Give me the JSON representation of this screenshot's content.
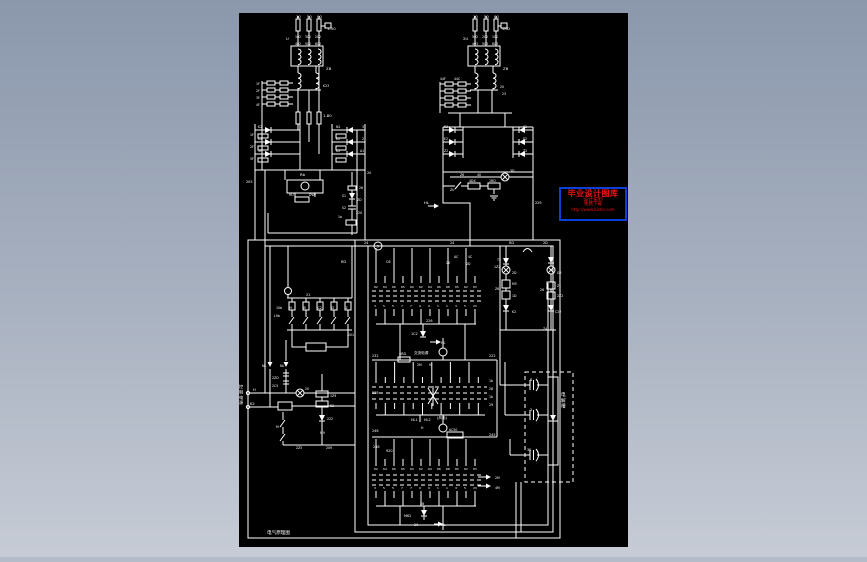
{
  "scene": {
    "bg_top": "#8b98ac",
    "bg_bottom": "#c7ccd6",
    "bg_strip": "#b5bcc9",
    "canvas_bg": "#000000",
    "ink": "#ffffff"
  },
  "watermark": {
    "border_color": "#0a3fd8",
    "bg": "#000000",
    "text_color": "#ef1212",
    "lines": [
      "毕业设计图库",
      "设计资料",
      "免费下载",
      "http://www.bishe.com"
    ]
  },
  "drawing": {
    "footer_note": "电气原理图",
    "ladder_labels": [
      "H",
      "B",
      "C2",
      "D",
      "Z"
    ],
    "strips": [
      {
        "top": [
          "62",
          "64",
          "66",
          "65",
          "60",
          "62",
          "64",
          "66",
          "68",
          "65",
          "62",
          "63"
        ],
        "bottom": [
          "3",
          "5",
          "5",
          "7",
          "7",
          "9",
          "9",
          "1",
          "1",
          "3",
          "5",
          "23"
        ]
      },
      {
        "top": [
          "",
          "",
          "",
          "",
          "",
          "",
          "",
          "",
          "",
          "",
          "",
          ""
        ],
        "bottom": [
          "",
          "",
          "",
          "",
          "",
          "",
          "",
          "",
          "",
          "",
          "",
          ""
        ]
      },
      {
        "top": [
          "62",
          "64",
          "66",
          "65",
          "60",
          "62",
          "64",
          "66",
          "68",
          "65",
          "62",
          "63"
        ],
        "bottom": [
          "3",
          "5",
          "5",
          "7",
          "7",
          "9",
          "9",
          "1",
          "1",
          "3",
          "5",
          "23"
        ]
      }
    ],
    "labels": [
      {
        "t": "10",
        "x": 296,
        "y": 18
      },
      {
        "t": "50",
        "x": 307,
        "y": 18
      },
      {
        "t": "00",
        "x": 317,
        "y": 18
      },
      {
        "t": "1-50",
        "x": 327,
        "y": 30
      },
      {
        "t": "U",
        "x": 286,
        "y": 40
      },
      {
        "t": "102",
        "x": 295,
        "y": 38,
        "s": 3.2
      },
      {
        "t": "302",
        "x": 305,
        "y": 38,
        "s": 3.2
      },
      {
        "t": "202",
        "x": 315,
        "y": 38,
        "s": 3.2
      },
      {
        "t": "402",
        "x": 295,
        "y": 45,
        "s": 3.2
      },
      {
        "t": "502",
        "x": 305,
        "y": 45,
        "s": 3.2
      },
      {
        "t": "602",
        "x": 315,
        "y": 45,
        "s": 3.2
      },
      {
        "t": "ZB",
        "x": 326,
        "y": 70
      },
      {
        "t": "1F",
        "x": 256,
        "y": 85,
        "s": 3.2
      },
      {
        "t": "2F",
        "x": 256,
        "y": 92,
        "s": 3.2
      },
      {
        "t": "3F",
        "x": 256,
        "y": 99,
        "s": 3.2
      },
      {
        "t": "4F",
        "x": 256,
        "y": 106,
        "s": 3.2
      },
      {
        "t": "K23",
        "x": 323,
        "y": 87,
        "s": 3.2
      },
      {
        "t": "1-80",
        "x": 323,
        "y": 117
      },
      {
        "t": "K2",
        "x": 258,
        "y": 128,
        "s": 3.2
      },
      {
        "t": "K2",
        "x": 258,
        "y": 140,
        "s": 3.2
      },
      {
        "t": "4F",
        "x": 258,
        "y": 152,
        "s": 3.2
      },
      {
        "t": "1F",
        "x": 250,
        "y": 136,
        "s": 3.2
      },
      {
        "t": "2F",
        "x": 250,
        "y": 148,
        "s": 3.2
      },
      {
        "t": "5F",
        "x": 250,
        "y": 160,
        "s": 3.2
      },
      {
        "t": "N2",
        "x": 336,
        "y": 128,
        "s": 3.2
      },
      {
        "t": "K2",
        "x": 336,
        "y": 140,
        "s": 3.2
      },
      {
        "t": "K2",
        "x": 336,
        "y": 152,
        "s": 3.2
      },
      {
        "t": "3",
        "x": 362,
        "y": 128,
        "s": 3.2
      },
      {
        "t": "2",
        "x": 362,
        "y": 140,
        "s": 3.2
      },
      {
        "t": "A1",
        "x": 360,
        "y": 152,
        "s": 3.2
      },
      {
        "t": "205",
        "x": 246,
        "y": 183,
        "s": 3.4
      },
      {
        "t": "20",
        "x": 367,
        "y": 174,
        "s": 3.4
      },
      {
        "t": "Rb",
        "x": 300,
        "y": 176
      },
      {
        "t": "HU",
        "x": 289,
        "y": 196,
        "s": 3.2
      },
      {
        "t": "DW",
        "x": 309,
        "y": 196,
        "s": 3.2
      },
      {
        "t": "26",
        "x": 359,
        "y": 189,
        "s": 3.2
      },
      {
        "t": "S1",
        "x": 342,
        "y": 197,
        "s": 3.2
      },
      {
        "t": "ZD",
        "x": 357,
        "y": 201,
        "s": 3.2
      },
      {
        "t": "S2",
        "x": 342,
        "y": 209,
        "s": 3.2
      },
      {
        "t": "1a",
        "x": 338,
        "y": 218,
        "s": 3.2
      },
      {
        "t": "220",
        "x": 356,
        "y": 214,
        "s": 3.2
      },
      {
        "t": "10",
        "x": 473,
        "y": 18
      },
      {
        "t": "50",
        "x": 484,
        "y": 18
      },
      {
        "t": "00",
        "x": 494,
        "y": 18
      },
      {
        "t": "4RD",
        "x": 502,
        "y": 30
      },
      {
        "t": "2U",
        "x": 463,
        "y": 40
      },
      {
        "t": "502",
        "x": 472,
        "y": 38,
        "s": 3.2
      },
      {
        "t": "202",
        "x": 482,
        "y": 38,
        "s": 3.2
      },
      {
        "t": "102",
        "x": 492,
        "y": 38,
        "s": 3.2
      },
      {
        "t": "403",
        "x": 472,
        "y": 45,
        "s": 3.2
      },
      {
        "t": "503",
        "x": 482,
        "y": 45,
        "s": 3.2
      },
      {
        "t": "603",
        "x": 492,
        "y": 45,
        "s": 3.2
      },
      {
        "t": "ZB",
        "x": 503,
        "y": 70
      },
      {
        "t": "44F",
        "x": 440,
        "y": 80,
        "s": 3.2
      },
      {
        "t": "44C",
        "x": 454,
        "y": 80,
        "s": 3.2
      },
      {
        "t": "20",
        "x": 500,
        "y": 88,
        "s": 3.2
      },
      {
        "t": "23",
        "x": 502,
        "y": 95,
        "s": 3.2
      },
      {
        "t": "K2",
        "x": 444,
        "y": 128,
        "s": 3.2
      },
      {
        "t": "E2",
        "x": 444,
        "y": 140,
        "s": 3.2
      },
      {
        "t": "Z2",
        "x": 444,
        "y": 152,
        "s": 3.2
      },
      {
        "t": "K2",
        "x": 523,
        "y": 128,
        "s": 3.2
      },
      {
        "t": "E2",
        "x": 523,
        "y": 140,
        "s": 3.2
      },
      {
        "t": "Z2",
        "x": 523,
        "y": 152,
        "s": 3.2
      },
      {
        "t": "Z6",
        "x": 460,
        "y": 176,
        "s": 3.2
      },
      {
        "t": "40",
        "x": 477,
        "y": 176,
        "s": 3.2
      },
      {
        "t": "3D",
        "x": 510,
        "y": 172,
        "s": 3.2
      },
      {
        "t": "ZU",
        "x": 450,
        "y": 191,
        "s": 3.2
      },
      {
        "t": "4DX",
        "x": 469,
        "y": 182,
        "s": 3.2
      },
      {
        "t": "1RD",
        "x": 489,
        "y": 182,
        "s": 3.2
      },
      {
        "t": "HL",
        "x": 424,
        "y": 204
      },
      {
        "t": "229",
        "x": 535,
        "y": 204,
        "s": 3.4
      },
      {
        "t": "24",
        "x": 364,
        "y": 244,
        "s": 3.4
      },
      {
        "t": "24",
        "x": 450,
        "y": 244,
        "s": 3.4
      },
      {
        "t": "3",
        "x": 376.6,
        "y": 247.6,
        "s": 3.4
      },
      {
        "t": "RD",
        "x": 341,
        "y": 263,
        "s": 3.4
      },
      {
        "t": "C6",
        "x": 386,
        "y": 263,
        "s": 3.4
      },
      {
        "t": "20",
        "x": 446,
        "y": 264,
        "s": 3.4
      },
      {
        "t": "AC",
        "x": 454,
        "y": 258,
        "s": 3.2
      },
      {
        "t": "4C",
        "x": 468,
        "y": 258,
        "s": 3.2
      },
      {
        "t": "2D",
        "x": 466,
        "y": 265,
        "s": 3.2
      },
      {
        "t": "RD",
        "x": 509,
        "y": 244,
        "s": 3.4
      },
      {
        "t": "2D",
        "x": 543,
        "y": 244,
        "s": 3.4
      },
      {
        "t": "T2",
        "x": 497,
        "y": 261,
        "s": 3.2
      },
      {
        "t": "1Z2",
        "x": 494,
        "y": 268,
        "s": 3.2
      },
      {
        "t": "2D",
        "x": 512,
        "y": 274,
        "s": 3.2
      },
      {
        "t": "M5",
        "x": 512,
        "y": 285,
        "s": 3.2
      },
      {
        "t": "Z6",
        "x": 495,
        "y": 290,
        "s": 3.2
      },
      {
        "t": "1D",
        "x": 512,
        "y": 297,
        "s": 3.2
      },
      {
        "t": "K2",
        "x": 512,
        "y": 313,
        "s": 3.2
      },
      {
        "t": "G2",
        "x": 557,
        "y": 274,
        "s": 3.2
      },
      {
        "t": "Z1",
        "x": 557,
        "y": 287,
        "s": 3.2
      },
      {
        "t": "26",
        "x": 540,
        "y": 291,
        "s": 3.2
      },
      {
        "t": "2Z2",
        "x": 557,
        "y": 297,
        "s": 3.2
      },
      {
        "t": "C22",
        "x": 555,
        "y": 313,
        "s": 3.2
      },
      {
        "t": "Z4",
        "x": 543,
        "y": 330,
        "s": 3.2
      },
      {
        "t": "21",
        "x": 306,
        "y": 296,
        "s": 3.4
      },
      {
        "t": "10b",
        "x": 276,
        "y": 309,
        "s": 3.2
      },
      {
        "t": "L9b",
        "x": 274,
        "y": 317,
        "s": 3.2
      },
      {
        "t": "201",
        "x": 348,
        "y": 336,
        "s": 3.2
      },
      {
        "t": "NL",
        "x": 262,
        "y": 367,
        "s": 3.4
      },
      {
        "t": "NL",
        "x": 280,
        "y": 367,
        "s": 3.4
      },
      {
        "t": "2ZD",
        "x": 272,
        "y": 379,
        "s": 3.2
      },
      {
        "t": "2C5",
        "x": 272,
        "y": 387,
        "s": 3.2
      },
      {
        "t": "控制电源",
        "x": 239,
        "y": 388,
        "s": 4.2,
        "v": 1
      },
      {
        "t": "H",
        "x": 253,
        "y": 391,
        "s": 3.6
      },
      {
        "t": "K2",
        "x": 250,
        "y": 405,
        "s": 3.6
      },
      {
        "t": "20",
        "x": 305,
        "y": 390,
        "s": 3.2
      },
      {
        "t": "1Z9",
        "x": 330,
        "y": 397,
        "s": 3.2
      },
      {
        "t": "K2",
        "x": 330,
        "y": 407,
        "s": 3.2
      },
      {
        "t": "222",
        "x": 327,
        "y": 420,
        "s": 3.2
      },
      {
        "t": "M",
        "x": 276,
        "y": 428,
        "s": 3.2
      },
      {
        "t": "M9",
        "x": 320,
        "y": 434,
        "s": 3.2
      },
      {
        "t": "2Z5",
        "x": 296,
        "y": 449,
        "s": 3.2
      },
      {
        "t": "209",
        "x": 326,
        "y": 449,
        "s": 3.2
      },
      {
        "t": "226",
        "x": 426,
        "y": 322,
        "s": 3.4
      },
      {
        "t": "1C2",
        "x": 411,
        "y": 335,
        "s": 3.4
      },
      {
        "t": "HL",
        "x": 441,
        "y": 344,
        "s": 3.4
      },
      {
        "t": "232",
        "x": 372,
        "y": 357,
        "s": 3.4
      },
      {
        "t": "4RD",
        "x": 399,
        "y": 355,
        "s": 3.4
      },
      {
        "t": "交流电源",
        "x": 414,
        "y": 354,
        "s": 3.6
      },
      {
        "t": "2M",
        "x": 417,
        "y": 366,
        "s": 3.2
      },
      {
        "t": "H",
        "x": 429,
        "y": 366,
        "s": 3.2
      },
      {
        "t": "222",
        "x": 489,
        "y": 357,
        "s": 3.4
      },
      {
        "t": "238",
        "x": 372,
        "y": 394,
        "s": 3.4
      },
      {
        "t": "HL1",
        "x": 411,
        "y": 421,
        "s": 3.4
      },
      {
        "t": "HL2",
        "x": 424,
        "y": 421,
        "s": 3.4
      },
      {
        "t": "(风电)",
        "x": 437,
        "y": 419,
        "s": 3.6
      },
      {
        "t": "1b",
        "x": 489,
        "y": 382,
        "s": 3.2
      },
      {
        "t": "28",
        "x": 489,
        "y": 390,
        "s": 3.2
      },
      {
        "t": "1b",
        "x": 489,
        "y": 398,
        "s": 3.2
      },
      {
        "t": "29",
        "x": 489,
        "y": 406,
        "s": 3.2
      },
      {
        "t": "246",
        "x": 372,
        "y": 432,
        "s": 3.4
      },
      {
        "t": "H",
        "x": 421,
        "y": 429,
        "s": 3.2
      },
      {
        "t": "AC50",
        "x": 449,
        "y": 431,
        "s": 3.2
      },
      {
        "t": "245",
        "x": 489,
        "y": 436,
        "s": 3.4
      },
      {
        "t": "248",
        "x": 373,
        "y": 448,
        "s": 3.4
      },
      {
        "t": "920",
        "x": 386,
        "y": 452,
        "s": 3.4
      },
      {
        "t": "2B",
        "x": 420,
        "y": 505,
        "s": 3.2
      },
      {
        "t": "M62",
        "x": 404,
        "y": 517,
        "s": 3.4
      },
      {
        "t": "20",
        "x": 414,
        "y": 526,
        "s": 3.4
      },
      {
        "t": "HL",
        "x": 441,
        "y": 526,
        "s": 3.4
      },
      {
        "t": "2M",
        "x": 495,
        "y": 479,
        "s": 3.2
      },
      {
        "t": "4M",
        "x": 495,
        "y": 489,
        "s": 3.2
      },
      {
        "t": "B",
        "x": 530,
        "y": 381,
        "s": 3.4
      },
      {
        "t": "3",
        "x": 530,
        "y": 411,
        "s": 3.4
      },
      {
        "t": "3K",
        "x": 527,
        "y": 451,
        "s": 3.4
      },
      {
        "t": "电解槽",
        "x": 561,
        "y": 396,
        "s": 4.6,
        "v": 1
      },
      {
        "t": "电气原理图",
        "x": 267,
        "y": 534,
        "s": 4.6
      }
    ]
  }
}
